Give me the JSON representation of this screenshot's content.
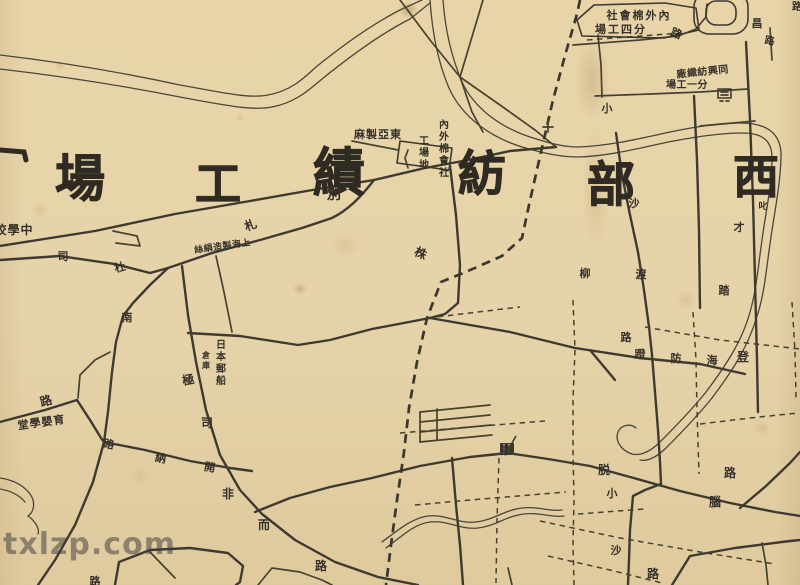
{
  "watermark": {
    "text": "txlzp.com"
  },
  "colors": {
    "paper": "#e9d7b0",
    "ink": "#3e3a30",
    "watermark_gray": "rgba(62,62,62,0.52)"
  },
  "map": {
    "region_titles": [
      {
        "t": "場",
        "x": 80,
        "y": 196,
        "s": 50
      },
      {
        "t": "工",
        "x": 218,
        "y": 200,
        "s": 46
      },
      {
        "t": "績",
        "x": 339,
        "y": 191,
        "s": 52
      },
      {
        "t": "紡",
        "x": 482,
        "y": 190,
        "s": 48
      },
      {
        "t": "部",
        "x": 611,
        "y": 201,
        "s": 48
      },
      {
        "t": "西",
        "x": 756,
        "y": 193,
        "s": 46
      }
    ],
    "labels": [
      {
        "t": "校學中",
        "x": 14,
        "y": 234,
        "s": 12,
        "ls": 1
      },
      {
        "t": "絲絹造製海上",
        "x": 223,
        "y": 249,
        "s": 9,
        "r": -8,
        "ls": 0.5
      },
      {
        "t": "札",
        "x": 252,
        "y": 229,
        "s": 12,
        "r": -20
      },
      {
        "t": "司",
        "x": 63,
        "y": 260,
        "s": 11
      },
      {
        "t": "杜",
        "x": 121,
        "y": 271,
        "s": 11,
        "r": -15
      },
      {
        "t": "別",
        "x": 334,
        "y": 199,
        "s": 14
      },
      {
        "t": "株",
        "x": 419,
        "y": 257,
        "s": 12,
        "r": 25
      },
      {
        "t": "麻製亞東",
        "x": 378,
        "y": 138,
        "s": 11,
        "ls": 1
      },
      {
        "t": "社會棉外內",
        "x": 639,
        "y": 19,
        "s": 11,
        "ls": 2
      },
      {
        "t": "場工四分",
        "x": 621,
        "y": 33,
        "s": 11,
        "ls": 2
      },
      {
        "t": "路",
        "x": 675,
        "y": 37,
        "s": 11,
        "r": 20
      },
      {
        "t": "昌",
        "x": 757,
        "y": 27,
        "s": 11
      },
      {
        "t": "路",
        "x": 769,
        "y": 44,
        "s": 10,
        "r": 10
      },
      {
        "t": "廠織紡興同",
        "x": 703,
        "y": 75,
        "s": 10,
        "r": -6,
        "ls": 0.5
      },
      {
        "t": "場工一分",
        "x": 687,
        "y": 88,
        "s": 10,
        "ls": 0.5
      },
      {
        "t": "小",
        "x": 607,
        "y": 112,
        "s": 11
      },
      {
        "t": "沙",
        "x": 634,
        "y": 207,
        "s": 11
      },
      {
        "t": "渡",
        "x": 641,
        "y": 278,
        "s": 11
      },
      {
        "t": "柳",
        "x": 585,
        "y": 277,
        "s": 11
      },
      {
        "t": "路",
        "x": 626,
        "y": 341,
        "s": 11
      },
      {
        "t": "蹬",
        "x": 640,
        "y": 358,
        "s": 11
      },
      {
        "t": "防",
        "x": 676,
        "y": 362,
        "s": 11
      },
      {
        "t": "海",
        "x": 712,
        "y": 364,
        "s": 11
      },
      {
        "t": "登",
        "x": 743,
        "y": 361,
        "s": 12
      },
      {
        "t": "叱",
        "x": 763,
        "y": 209,
        "s": 9
      },
      {
        "t": "才",
        "x": 739,
        "y": 231,
        "s": 11
      },
      {
        "t": "踏",
        "x": 724,
        "y": 294,
        "s": 11
      },
      {
        "t": "脱",
        "x": 604,
        "y": 474,
        "s": 12
      },
      {
        "t": "小",
        "x": 612,
        "y": 497,
        "s": 11
      },
      {
        "t": "沙",
        "x": 616,
        "y": 554,
        "s": 11
      },
      {
        "t": "路",
        "x": 653,
        "y": 578,
        "s": 12
      },
      {
        "t": "腦",
        "x": 715,
        "y": 506,
        "s": 12
      },
      {
        "t": "路",
        "x": 730,
        "y": 477,
        "s": 12
      },
      {
        "t": "康",
        "x": 506,
        "y": 454,
        "s": 11,
        "w": 700
      },
      {
        "t": "極",
        "x": 189,
        "y": 384,
        "s": 12,
        "r": -10
      },
      {
        "t": "司",
        "x": 207,
        "y": 427,
        "s": 12
      },
      {
        "t": "非",
        "x": 228,
        "y": 498,
        "s": 12
      },
      {
        "t": "而",
        "x": 264,
        "y": 529,
        "s": 12,
        "w": 700
      },
      {
        "t": "路",
        "x": 321,
        "y": 570,
        "s": 12,
        "w": 700
      },
      {
        "t": "南",
        "x": 127,
        "y": 321,
        "s": 11,
        "w": 700
      },
      {
        "t": "路",
        "x": 47,
        "y": 405,
        "s": 12,
        "r": -15
      },
      {
        "t": "堂學嬰育",
        "x": 42,
        "y": 426,
        "s": 11,
        "r": -8,
        "ls": 1
      },
      {
        "t": "路",
        "x": 108,
        "y": 448,
        "s": 11,
        "r": 10
      },
      {
        "t": "納",
        "x": 160,
        "y": 462,
        "s": 11,
        "r": 10
      },
      {
        "t": "開",
        "x": 209,
        "y": 471,
        "s": 11,
        "r": 10
      },
      {
        "t": "路",
        "x": 95,
        "y": 585,
        "s": 11
      },
      {
        "t": "路",
        "x": 797,
        "y": 10,
        "s": 10
      }
    ],
    "vertical_labels": [
      {
        "t": "日本郵船",
        "x": 221,
        "y": 348,
        "s": 10
      },
      {
        "t": "倉庫",
        "x": 206,
        "y": 358,
        "s": 8
      },
      {
        "t": "內外棉會社",
        "x": 444,
        "y": 128,
        "s": 10
      },
      {
        "t": "工場地",
        "x": 424,
        "y": 144,
        "s": 10
      }
    ]
  }
}
